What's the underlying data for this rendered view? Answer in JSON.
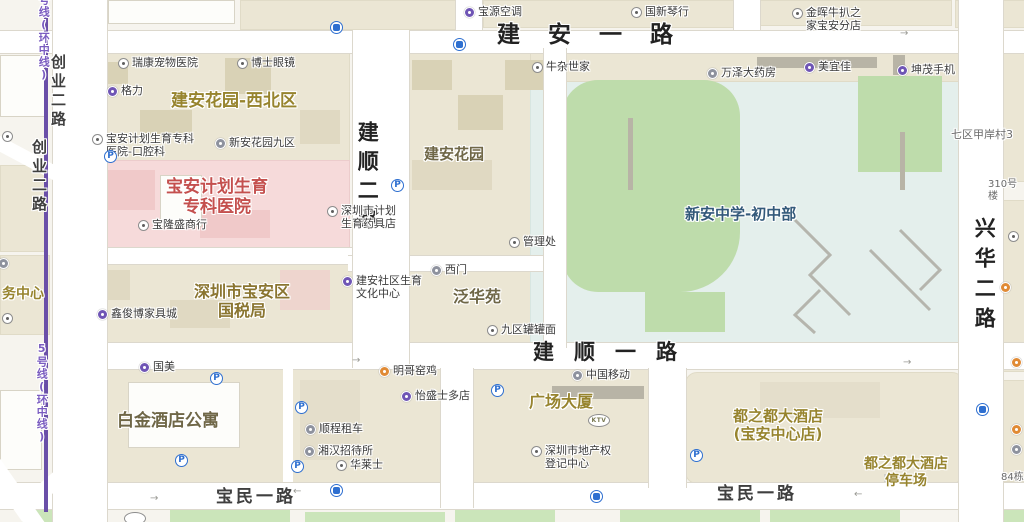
{
  "colors": {
    "street": "#222222",
    "street2": "#3f3f3f",
    "olive": "#97842e",
    "olive_dark": "#6f6747",
    "brown": "#8a7530",
    "red": "#c4504e",
    "school": "#33597a",
    "poi": "#3a3a3a",
    "small": "#6a6a6a",
    "metro_text": "#7a5cc0",
    "metro_line": "#6a4fa8",
    "parking_blue": "#2e6fd0",
    "field_green": "#bedcab",
    "hospital_pink": "#f6dada"
  },
  "metro": {
    "top_label": "号线(环中线)",
    "bottom_label": "5号线(环中线)"
  },
  "streets": [
    {
      "id": "jianan-yilu",
      "label": "建安一路",
      "x": 497,
      "y": 22,
      "size": 23,
      "ls": 28,
      "color": "street"
    },
    {
      "id": "jianshun-yilu",
      "label": "建顺一路",
      "x": 533,
      "y": 340,
      "size": 21,
      "ls": 20,
      "color": "street"
    },
    {
      "id": "baomin-yilu-west",
      "label": "宝民一路",
      "x": 216,
      "y": 487,
      "size": 17,
      "ls": 3,
      "color": "street2"
    },
    {
      "id": "baomin-yilu-east",
      "label": "宝民一路",
      "x": 717,
      "y": 484,
      "size": 17,
      "ls": 3,
      "color": "street2"
    },
    {
      "id": "jianshun-erlu",
      "label": "建顺二路",
      "x": 354,
      "y": 121,
      "size": 21,
      "ls": 8,
      "v": true,
      "color": "street"
    },
    {
      "id": "xinghua-erlu",
      "label": "兴华二路",
      "x": 971,
      "y": 217,
      "size": 21,
      "ls": 9,
      "v": true,
      "color": "street"
    },
    {
      "id": "chuangye-erlu-a",
      "label": "创业二路",
      "x": 49,
      "y": 54,
      "size": 15,
      "ls": 4,
      "v": true,
      "color": "street2"
    },
    {
      "id": "chuangye-erlu-b",
      "label": "创业二路",
      "x": 30,
      "y": 139,
      "size": 15,
      "ls": 4,
      "v": true,
      "color": "street2"
    },
    {
      "id": "metro-label-top",
      "label": "号线(环中线)",
      "x": 37,
      "y": -6,
      "size": 11,
      "ls": 1,
      "v": true,
      "color": "metro_text"
    },
    {
      "id": "metro-label-bottom",
      "label": "5号线(环中线)",
      "x": 35,
      "y": 342,
      "size": 11,
      "ls": 1,
      "v": true,
      "color": "metro_text"
    }
  ],
  "areas": [
    {
      "id": "jianan-huayuan-xibei",
      "label": "建安花园-西北区",
      "x": 171,
      "y": 91,
      "size": 17,
      "color": "olive"
    },
    {
      "id": "baoan-hospital",
      "label": "宝安计划生育\n专科医院",
      "x": 217,
      "y": 177,
      "size": 17,
      "color": "red",
      "center": true
    },
    {
      "id": "guoshuiju",
      "label": "深圳市宝安区\n国税局",
      "x": 242,
      "y": 282,
      "size": 16,
      "color": "brown",
      "center": true
    },
    {
      "id": "jianan-huayuan",
      "label": "建安花园",
      "x": 424,
      "y": 145,
      "size": 15,
      "color": "olive_dark"
    },
    {
      "id": "fanhuayuan",
      "label": "泛华苑",
      "x": 453,
      "y": 287,
      "size": 16,
      "color": "olive_dark"
    },
    {
      "id": "xinan-middle-school",
      "label": "新安中学-初中部",
      "x": 685,
      "y": 205,
      "size": 15,
      "color": "school"
    },
    {
      "id": "baijin-hotel",
      "label": "白金酒店公寓",
      "x": 117,
      "y": 411,
      "size": 17,
      "color": "olive_dark"
    },
    {
      "id": "guangchang-dasha",
      "label": "广场大厦",
      "x": 529,
      "y": 392,
      "size": 16,
      "color": "olive"
    },
    {
      "id": "duzhidu-hotel",
      "label": "都之都大酒店\n(宝安中心店)",
      "x": 778,
      "y": 407,
      "size": 15,
      "color": "olive",
      "center": true
    },
    {
      "id": "duzhidu-parking",
      "label": "都之都大酒店\n停车场",
      "x": 906,
      "y": 456,
      "size": 14,
      "color": "olive",
      "center": true
    },
    {
      "id": "wu-zhongxin",
      "label": "务中心",
      "x": 2,
      "y": 286,
      "size": 14,
      "color": "olive"
    },
    {
      "id": "qiqu-jiaancun",
      "label": "七区甲岸村3",
      "x": 951,
      "y": 128,
      "size": 11,
      "color": "small",
      "plain": true
    },
    {
      "id": "lou-310",
      "label": "310号楼",
      "x": 988,
      "y": 179,
      "size": 10,
      "color": "small",
      "plain": true
    },
    {
      "id": "dong-84",
      "label": "84栋",
      "x": 1001,
      "y": 472,
      "size": 10,
      "color": "small",
      "plain": true
    }
  ],
  "pois": [
    {
      "id": "ruikang-pet-hospital",
      "label": "瑞康宠物医院",
      "x": 124,
      "y": 64,
      "type": "dot"
    },
    {
      "id": "boshi-glasses",
      "label": "博士眼镜",
      "x": 243,
      "y": 64,
      "type": "dot"
    },
    {
      "id": "geli",
      "label": "格力",
      "x": 113,
      "y": 92,
      "type": "purple"
    },
    {
      "id": "jihua-kouqiang",
      "label": "宝安计划生育专科\n医院-口腔科",
      "x": 98,
      "y": 140,
      "type": "dot"
    },
    {
      "id": "xinan-huayuan-9",
      "label": "新安花园九区",
      "x": 221,
      "y": 144,
      "type": "grey"
    },
    {
      "id": "baolongsheng",
      "label": "宝隆盛商行",
      "x": 144,
      "y": 226,
      "type": "dot"
    },
    {
      "id": "xinjunbo-furniture",
      "label": "鑫俊博家具城",
      "x": 103,
      "y": 315,
      "type": "purple"
    },
    {
      "id": "baoyuan-kongtiao",
      "label": "宝源空调",
      "x": 470,
      "y": 13,
      "type": "purple"
    },
    {
      "id": "guoxin-qinhang",
      "label": "国新琴行",
      "x": 637,
      "y": 13,
      "type": "dot"
    },
    {
      "id": "jinhui-steak",
      "label": "金晖牛扒之\n家宝安分店",
      "x": 798,
      "y": 14,
      "type": "dot"
    },
    {
      "id": "niuza-shijia",
      "label": "牛杂世家",
      "x": 538,
      "y": 68,
      "type": "dot"
    },
    {
      "id": "wanze-pharmacy",
      "label": "万泽大药房",
      "x": 713,
      "y": 74,
      "type": "grey"
    },
    {
      "id": "meiyijia",
      "label": "美宜佳",
      "x": 810,
      "y": 68,
      "type": "purple"
    },
    {
      "id": "kunmao-phone",
      "label": "坤茂手机",
      "x": 903,
      "y": 71,
      "type": "purple"
    },
    {
      "id": "jihua-yaojudian",
      "label": "深圳市计划\n生育药具店",
      "x": 333,
      "y": 212,
      "type": "dot"
    },
    {
      "id": "guanlichu",
      "label": "管理处",
      "x": 515,
      "y": 243,
      "type": "dot"
    },
    {
      "id": "west-gate",
      "label": "西门",
      "x": 437,
      "y": 271,
      "type": "grey"
    },
    {
      "id": "shequ-culture-center",
      "label": "建安社区生育\n文化中心",
      "x": 348,
      "y": 282,
      "type": "purple"
    },
    {
      "id": "jiuqu-guanguanmian",
      "label": "九区罐罐面",
      "x": 493,
      "y": 331,
      "type": "dot"
    },
    {
      "id": "guomei",
      "label": "国美",
      "x": 145,
      "y": 368,
      "type": "purple"
    },
    {
      "id": "mingge-yaoji",
      "label": "明哥窑鸡",
      "x": 385,
      "y": 372,
      "type": "orange"
    },
    {
      "id": "yisheng-store",
      "label": "怡盛士多店",
      "x": 407,
      "y": 397,
      "type": "purple"
    },
    {
      "id": "china-mobile",
      "label": "中国移动",
      "x": 578,
      "y": 376,
      "type": "grey"
    },
    {
      "id": "shuncheng-zuche",
      "label": "顺程租车",
      "x": 311,
      "y": 430,
      "type": "grey"
    },
    {
      "id": "xianghan-hostel",
      "label": "湘汉招待所",
      "x": 310,
      "y": 452,
      "type": "grey"
    },
    {
      "id": "hualaishi",
      "label": "华莱士",
      "x": 342,
      "y": 466,
      "type": "dot"
    },
    {
      "id": "dichanquan-center",
      "label": "深圳市地产权\n登记中心",
      "x": 537,
      "y": 452,
      "type": "dot"
    }
  ],
  "icons": {
    "parking": {
      "glyph": "P",
      "points": [
        [
          111,
          157
        ],
        [
          398,
          186
        ],
        [
          217,
          379
        ],
        [
          302,
          408
        ],
        [
          182,
          461
        ],
        [
          298,
          467
        ],
        [
          498,
          391
        ],
        [
          697,
          456
        ]
      ]
    },
    "bus": {
      "points": [
        [
          337,
          28
        ],
        [
          460,
          45
        ],
        [
          983,
          410
        ],
        [
          337,
          491
        ],
        [
          597,
          497
        ]
      ]
    },
    "edge": [
      {
        "x": 1017,
        "y": 363,
        "type": "orange"
      },
      {
        "x": 1017,
        "y": 430,
        "type": "orange"
      },
      {
        "x": 1017,
        "y": 450,
        "type": "grey"
      },
      {
        "x": 1014,
        "y": 237,
        "type": "dot"
      },
      {
        "x": 1006,
        "y": 288,
        "type": "orange"
      },
      {
        "x": 4,
        "y": 264,
        "type": "grey"
      },
      {
        "x": 8,
        "y": 319,
        "type": "dot"
      },
      {
        "x": 8,
        "y": 137,
        "type": "dot"
      }
    ]
  },
  "badges": [
    {
      "id": "ktv-badge",
      "label": "KTV",
      "x": 598,
      "y": 420
    },
    {
      "id": "partial-badge",
      "label": "",
      "x": 134,
      "y": 518
    }
  ],
  "arrows": [
    {
      "ch": "→",
      "x": 352,
      "y": 356
    },
    {
      "ch": "→",
      "x": 900,
      "y": 29
    },
    {
      "ch": "→",
      "x": 150,
      "y": 494
    },
    {
      "ch": "←",
      "x": 293,
      "y": 487
    },
    {
      "ch": "←",
      "x": 854,
      "y": 490
    },
    {
      "ch": "→",
      "x": 903,
      "y": 358
    }
  ]
}
